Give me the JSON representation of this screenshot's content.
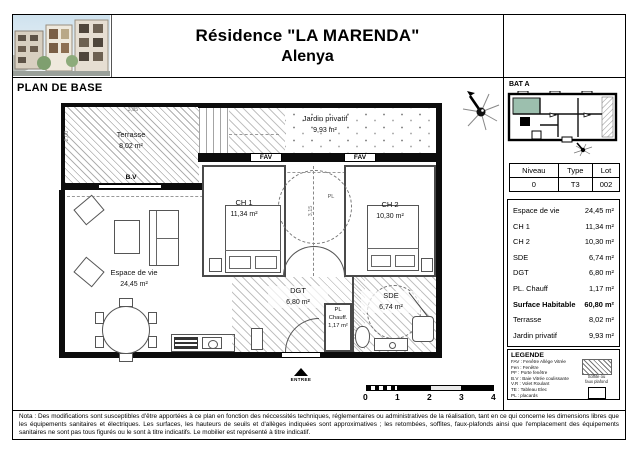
{
  "header": {
    "line1": "Résidence \"LA MARENDA\"",
    "line2": "Alenya"
  },
  "plan": {
    "title": "PLAN DE BASE",
    "rooms": {
      "terrasse": {
        "name": "Terrasse",
        "area": "8,02 m²"
      },
      "jardin": {
        "name": "Jardin privatif",
        "area": "9,93 m²"
      },
      "ch1": {
        "name": "CH 1",
        "area": "11,34 m²"
      },
      "ch2": {
        "name": "CH 2",
        "area": "10,30 m²"
      },
      "vie": {
        "name": "Espace de vie",
        "area": "24,45 m²"
      },
      "dgt": {
        "name": "DGT",
        "area": "6,80 m²"
      },
      "sde": {
        "name": "SDE",
        "area": "6,74 m²"
      },
      "pl_chauff": {
        "l1": "PL",
        "l2": "Chauff.",
        "area": "1,17 m²"
      }
    },
    "markers": {
      "bv": "B.V",
      "fav": "FAV",
      "pl": "PL",
      "entree": "ENTREE"
    },
    "dims": {
      "terrace_width": "3,85",
      "terrace_depth": "2,00",
      "window_left": "3,84",
      "window_right": ".97",
      "hall_depth": "3,15"
    },
    "scale": [
      "0",
      "1",
      "2",
      "3",
      "4"
    ]
  },
  "sidebar": {
    "bat_label": "BAT A",
    "unit_table": {
      "headers": [
        "Niveau",
        "Type",
        "Lot"
      ],
      "values": [
        "0",
        "T3",
        "002"
      ]
    },
    "areas": [
      {
        "label": "Espace de vie",
        "value": "24,45 m²"
      },
      {
        "label": "CH 1",
        "value": "11,34 m²"
      },
      {
        "label": "CH 2",
        "value": "10,30 m²"
      },
      {
        "label": "SDE",
        "value": "6,74 m²"
      },
      {
        "label": "DGT",
        "value": "6,80 m²"
      },
      {
        "label": "PL. Chauff",
        "value": "1,17 m²"
      },
      {
        "label": "Surface Habitable",
        "value": "60,80 m²"
      },
      {
        "label": "Terrasse",
        "value": "8,02 m²"
      },
      {
        "label": "Jardin privatif",
        "value": "9,93 m²"
      }
    ],
    "legend": {
      "title": "LEGENDE",
      "items": [
        "FAV : Fenêtre Allège Vitrée",
        "Fen : Fenêtre",
        "PF : Porte fenêtre",
        "B.V : Baie Vitrée coulissante",
        "V.R : Volet Roulant",
        "TE : Tableau Elec",
        "PL : placards"
      ],
      "soffite1": "Soffite ou",
      "soffite2": "faux plafond",
      "gaine": "Gaine technique"
    }
  },
  "footer": {
    "nota": "Nota : Des modifications sont susceptibles d'être apportées à ce plan en fonction des néccessités techniques, réglementaires ou administratives de la réalisation, tant en ce qui concerne les dimensions libres que les équipements sanitaires et électriques. Les surfaces, les hauteurs de seuils et d'allèges indiquées sont approximatives ; les retombées, soffites, faux-plafonds ainsi que l'emplacement des équipements sanitaires ne sont pas tous figurés ou le sont à titre indicatifs. Le mobilier est représenté à titre indicatif."
  },
  "colors": {
    "unit_highlight": "#9cbfae"
  }
}
